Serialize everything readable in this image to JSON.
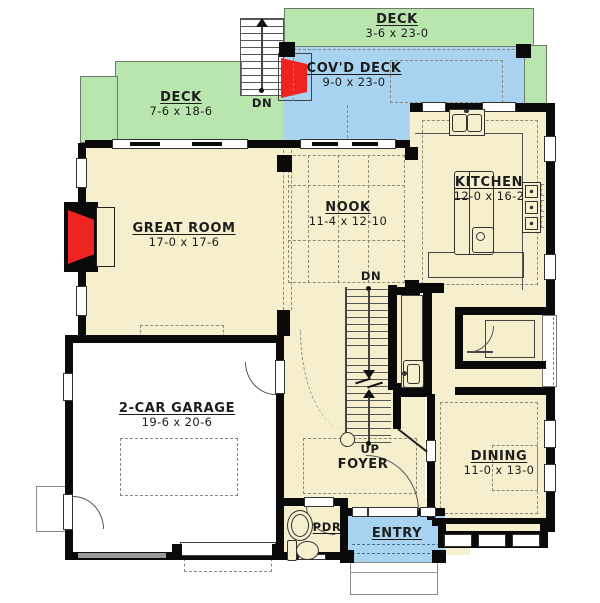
{
  "title": "First floor plan",
  "rooms": {
    "deck_top": {
      "label": "DECK",
      "dims": "3-6 x 23-0"
    },
    "covd_deck": {
      "label": "COV'D DECK",
      "dims": "9-0 x 23-0"
    },
    "deck_left": {
      "label": "DECK",
      "dims": "7-6 x 18-6"
    },
    "great_room": {
      "label": "GREAT ROOM",
      "dims": "17-0 x 17-6"
    },
    "nook": {
      "label": "NOOK",
      "dims": "11-4 x 12-10"
    },
    "kitchen": {
      "label": "KITCHEN",
      "dims": "12-0 x 16-2"
    },
    "garage": {
      "label": "2-CAR GARAGE",
      "dims": "19-6 x 20-6"
    },
    "dining": {
      "label": "DINING",
      "dims": "11-0 x 13-0"
    },
    "foyer": {
      "label": "FOYER"
    },
    "powder": {
      "label": "PDR"
    },
    "entry": {
      "label": "ENTRY"
    }
  },
  "stairs": {
    "deck_down": "DN",
    "interior_down": "DN",
    "interior_up": "UP"
  },
  "colors": {
    "deck_green": "#b9e5ae",
    "covered_deck_blue": "#a8d4f2",
    "floor_cream": "#f5efcd",
    "fireplace_red": "#ee2421",
    "wall_black": "#0a0a0a"
  }
}
